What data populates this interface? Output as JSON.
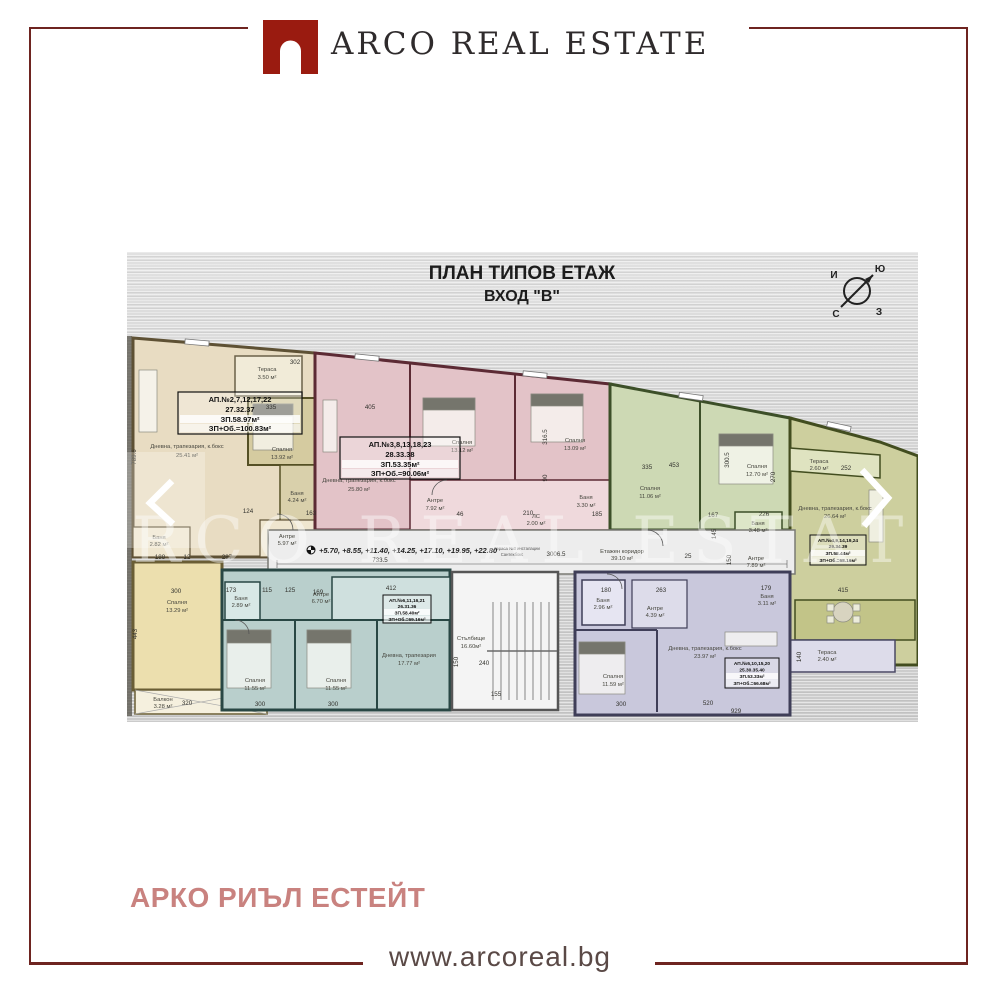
{
  "header": {
    "logo_text": "ARCO REAL ESTATE",
    "logo_color": "#9a1b10",
    "text_color": "#2f2b2c"
  },
  "footer": {
    "brand_cyrillic": "АРКО РИЪЛ ЕСТЕЙТ",
    "brand_color": "#c9827f",
    "website": "www.arcoreal.bg",
    "frame_color": "#6e2420"
  },
  "plan": {
    "title": "ПЛАН ТИПОВ ЕТАЖ",
    "subtitle": "ВХОД \"В\"",
    "watermark": "ARCO REAL ESTATE",
    "compass": {
      "top_left": "И",
      "top_right": "Ю",
      "bottom_left": "С",
      "bottom_right": "З"
    },
    "elevations": "+5.70, +8.55, +11.40, +14.25, +17.10, +19.95, +22.80",
    "corridor": {
      "label": "Етажен коридор",
      "area": "39.10 м²",
      "dim_total": "3006.5",
      "dim_axis": "733.5",
      "note1": "Тераса №3 инсталации",
      "note2": "Сантехбокс"
    },
    "stairs": {
      "label": "Стълбище",
      "area": "16.60м²",
      "dims": [
        "150",
        "240",
        "155"
      ]
    },
    "apartments": [
      {
        "id": "beige",
        "color": "#e8dcc2",
        "label_rows": [
          "АП.№2,7,12,17,22",
          "27.32.37",
          "ЗП.58.97м²",
          "ЗП+Об.=100.83м²"
        ],
        "rooms": [
          {
            "name": "Тераса",
            "area": "3.50 м²"
          },
          {
            "name": "Дневна, трапезария, к.бокс",
            "area": "25.41 м²"
          },
          {
            "name": "Спалня",
            "area": "13.92 м²"
          },
          {
            "name": "Баня",
            "area": "4.24 м²"
          },
          {
            "name": "Антре",
            "area": "5.97 м²"
          },
          {
            "name": "Баня",
            "area": "2.82 м²"
          }
        ],
        "dims": [
          "789.6",
          "335",
          "302",
          "163",
          "124",
          "188",
          "12",
          "287"
        ]
      },
      {
        "id": "pink",
        "color": "#e3c3c8",
        "label_rows": [
          "АП.№3,8,13,18,23",
          "28.33.38",
          "ЗП.53.35м²",
          "ЗП+Об.=90.06м²"
        ],
        "rooms": [
          {
            "name": "Дневна, трапезария, к.бокс",
            "area": "25.80 м²"
          },
          {
            "name": "Спалня",
            "area": "13.12 м²"
          },
          {
            "name": "Спалня",
            "area": "13.09 м²"
          },
          {
            "name": "Антре",
            "area": "7.92 м²"
          },
          {
            "name": "Баня",
            "area": "3.30 м²"
          },
          {
            "name": "ЛС",
            "area": "2.00 м²"
          }
        ],
        "dims": [
          "405",
          "316.5",
          "90",
          "210",
          "185",
          "46"
        ]
      },
      {
        "id": "green",
        "color": "#cdd9b4",
        "label_rows": [],
        "rooms": [
          {
            "name": "Спалня",
            "area": "11.06 м²"
          },
          {
            "name": "Спалня",
            "area": "12.70 м²"
          },
          {
            "name": "Баня",
            "area": "3.48 м²"
          },
          {
            "name": "Антре",
            "area": "7.89 м²"
          }
        ],
        "dims": [
          "335",
          "453",
          "300.5",
          "270",
          "167",
          "226",
          "145",
          "150",
          "25"
        ]
      },
      {
        "id": "olive",
        "color": "#cdcf9e",
        "label_rows": [
          "АП.№4,9,14,19,24",
          "29.34.39",
          "ЗП.58.44м²",
          "ЗП+Об.=68.16м²"
        ],
        "rooms": [
          {
            "name": "Тераса",
            "area": "2.60 м²"
          },
          {
            "name": "Дневна, трапезария, к.бокс",
            "area": "26.64 м²"
          },
          {
            "name": "Баня",
            "area": "3.11 м²"
          },
          {
            "name": "Тераса",
            "area": "2.40 м²"
          }
        ],
        "dims": [
          "252",
          "415",
          "140",
          "179"
        ]
      },
      {
        "id": "teal",
        "color": "#b9cfcc",
        "label_rows": [
          "АП.№6,11,16,21",
          "26.31.36",
          "ЗП.58.40м²",
          "ЗП+Об.=69.16м²"
        ],
        "rooms": [
          {
            "name": "Баня",
            "area": "2.89 м²"
          },
          {
            "name": "Антре",
            "area": "6.70 м²"
          },
          {
            "name": "Спалня",
            "area": "11.55 м²"
          },
          {
            "name": "Спалня",
            "area": "11.55 м²"
          },
          {
            "name": "Дневна, трапезария",
            "area": "17.77 м²"
          }
        ],
        "dims": [
          "173",
          "115",
          "125",
          "169",
          "412",
          "300",
          "300"
        ]
      },
      {
        "id": "purple",
        "color": "#c9c8dc",
        "label_rows": [
          "АП.№5,10,15,20",
          "25.30.35.40",
          "ЗП.53.33м²",
          "ЗП+Об.=66.68м²"
        ],
        "rooms": [
          {
            "name": "Баня",
            "area": "2.96 м²"
          },
          {
            "name": "Антре",
            "area": "4.39 м²"
          },
          {
            "name": "Спалня",
            "area": "11.59 м²"
          },
          {
            "name": "Дневна, трапезария, к.бокс",
            "area": "23.97 м²"
          }
        ],
        "dims": [
          "180",
          "263",
          "300",
          "520",
          "929"
        ]
      },
      {
        "id": "yellow",
        "color": "#ecdfae",
        "label_rows": [],
        "rooms": [
          {
            "name": "Спалня",
            "area": "13.29 м²"
          },
          {
            "name": "Балкон",
            "area": "3.28 м²"
          }
        ],
        "dims": [
          "300",
          "443",
          "320"
        ]
      }
    ]
  }
}
